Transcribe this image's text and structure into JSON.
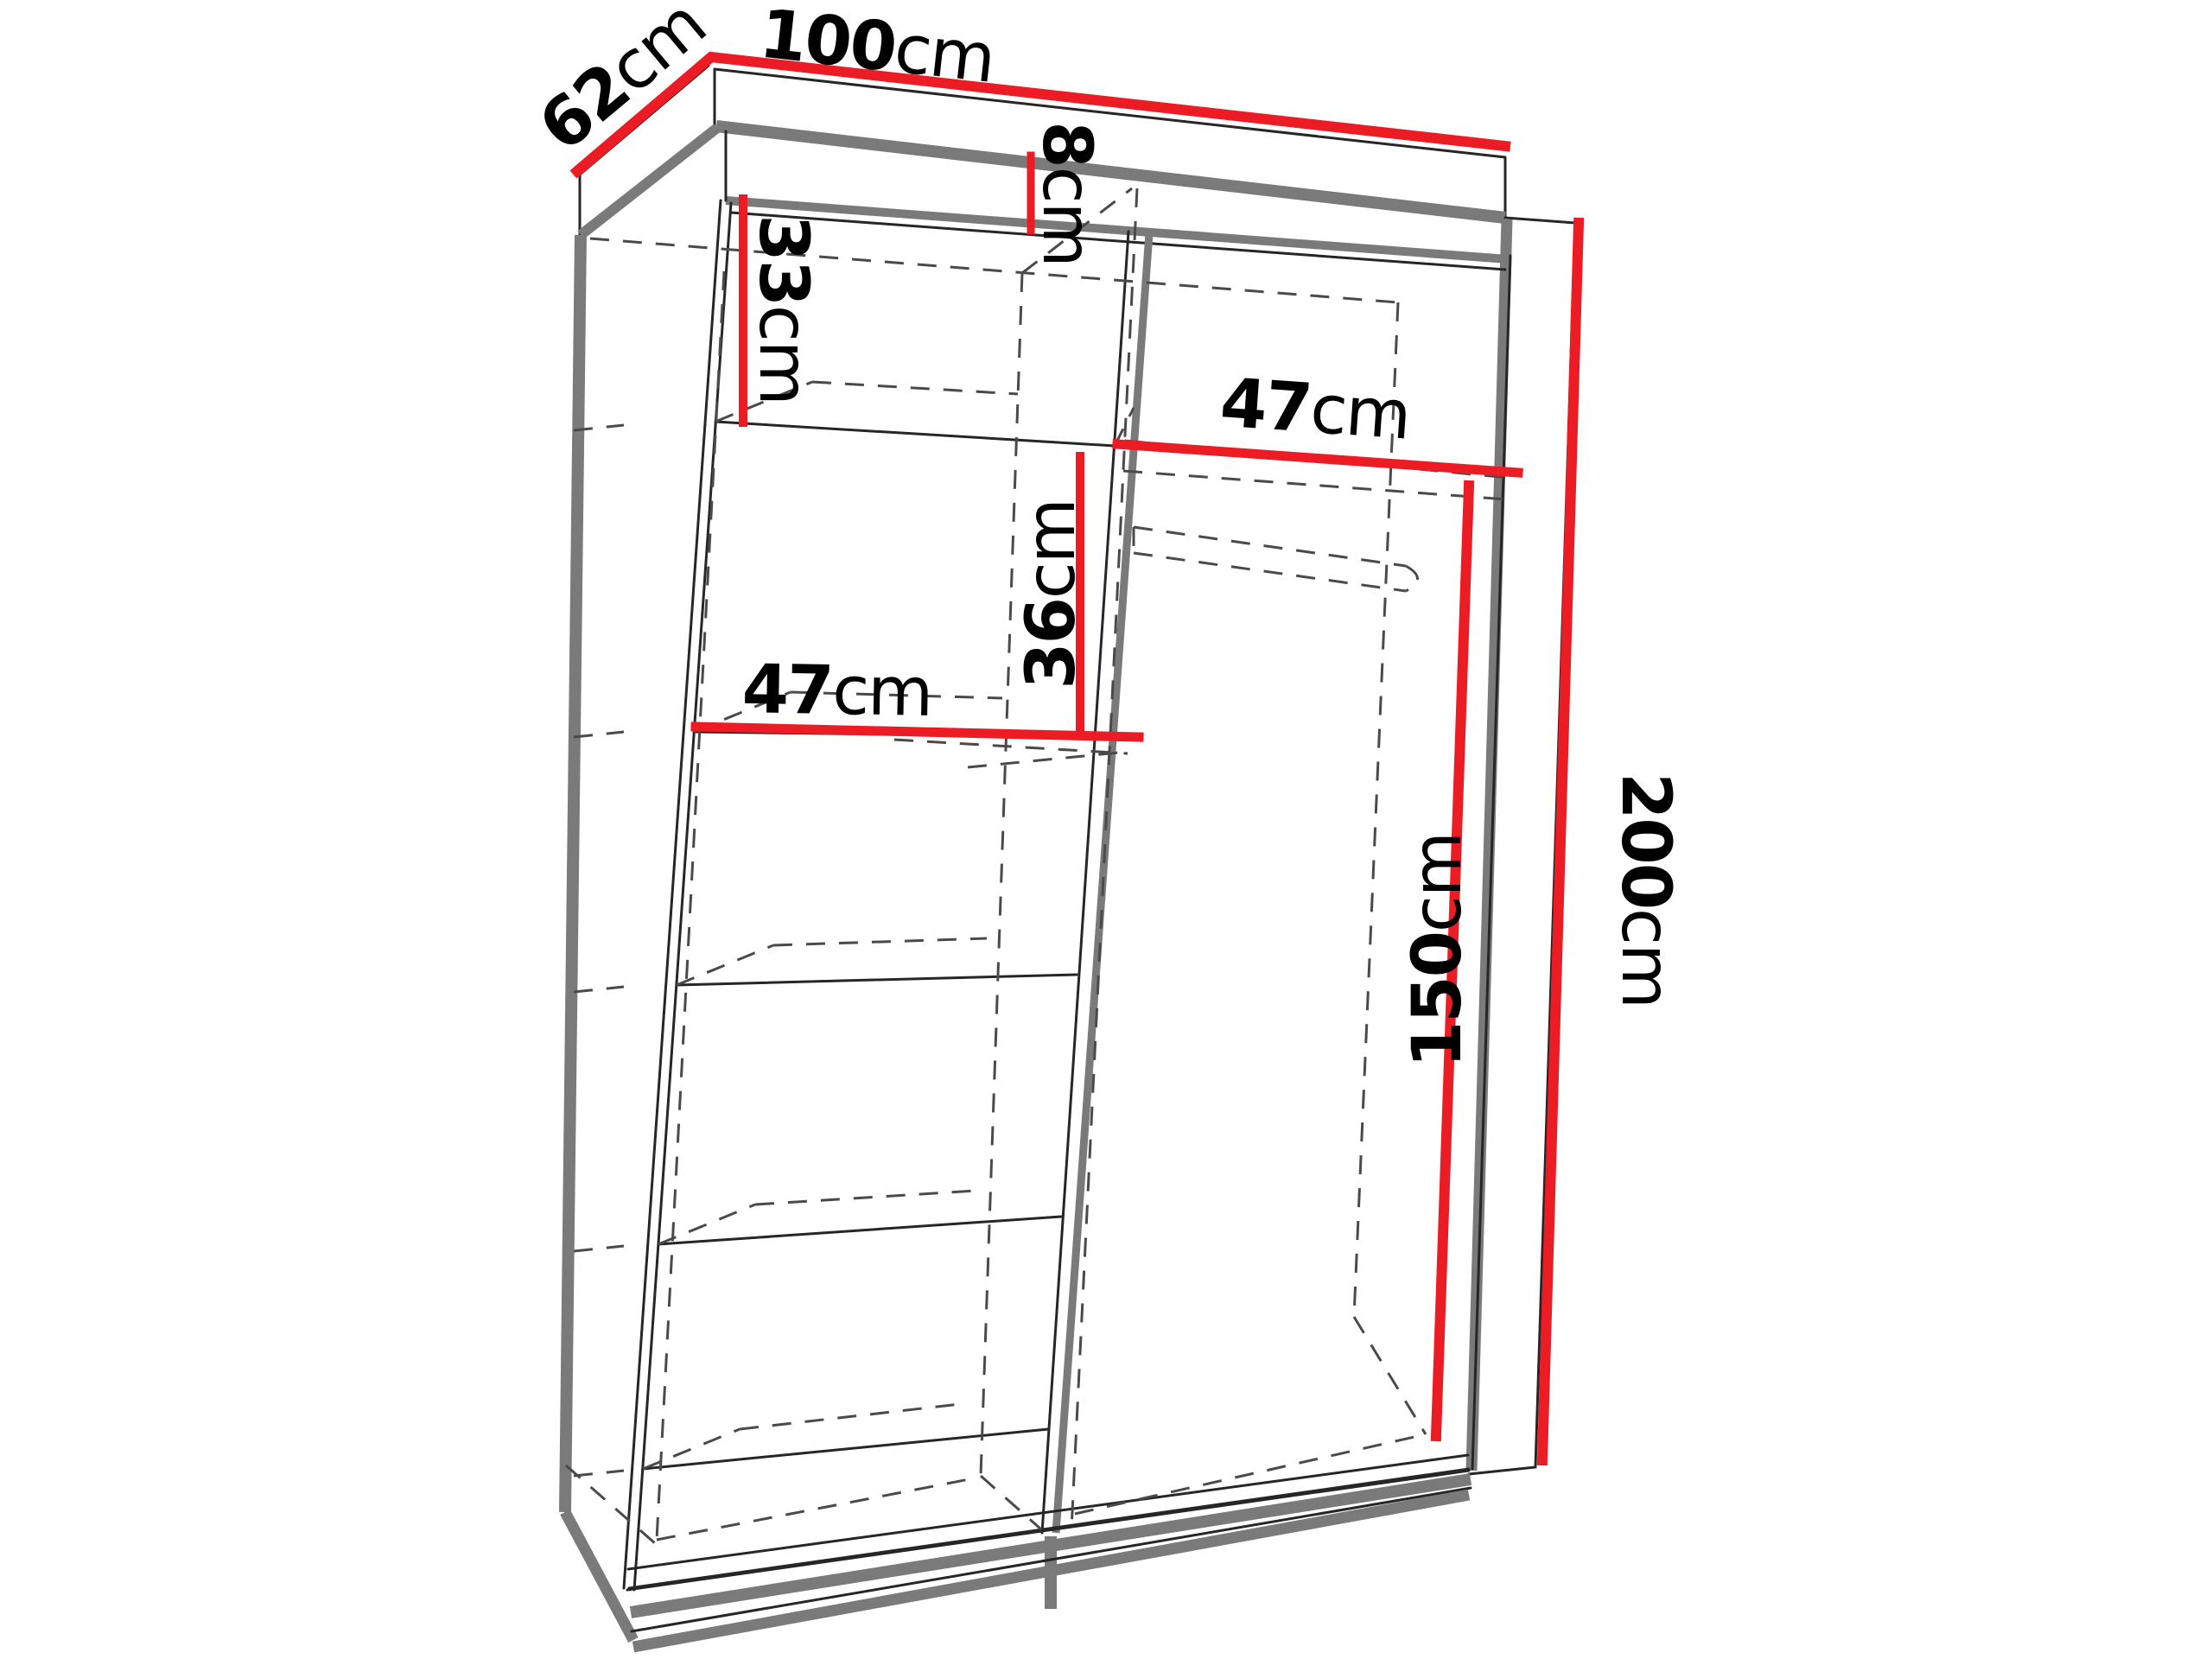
{
  "diagram": {
    "title": "wardrobe-dimension-diagram",
    "unit": "cm",
    "colors": {
      "dimension_line": "#ec1c24",
      "outline": "#262626",
      "panel_edge": "#7a7a7a",
      "hidden_line": "#4a4a4a",
      "text": "#000000",
      "background": "#ffffff"
    },
    "dimensions": {
      "width": {
        "number": "100",
        "unit": "cm"
      },
      "depth": {
        "number": "62",
        "unit": "cm"
      },
      "top_gap": {
        "number": "8",
        "unit": "cm"
      },
      "left_top_shelf": {
        "number": "33",
        "unit": "cm"
      },
      "right_shelf": {
        "number": "47",
        "unit": "cm"
      },
      "center_gap": {
        "number": "36",
        "unit": "cm"
      },
      "left_shelf": {
        "number": "47",
        "unit": "cm"
      },
      "hanging_space": {
        "number": "150",
        "unit": "cm"
      },
      "total_height": {
        "number": "200",
        "unit": "cm"
      }
    }
  }
}
